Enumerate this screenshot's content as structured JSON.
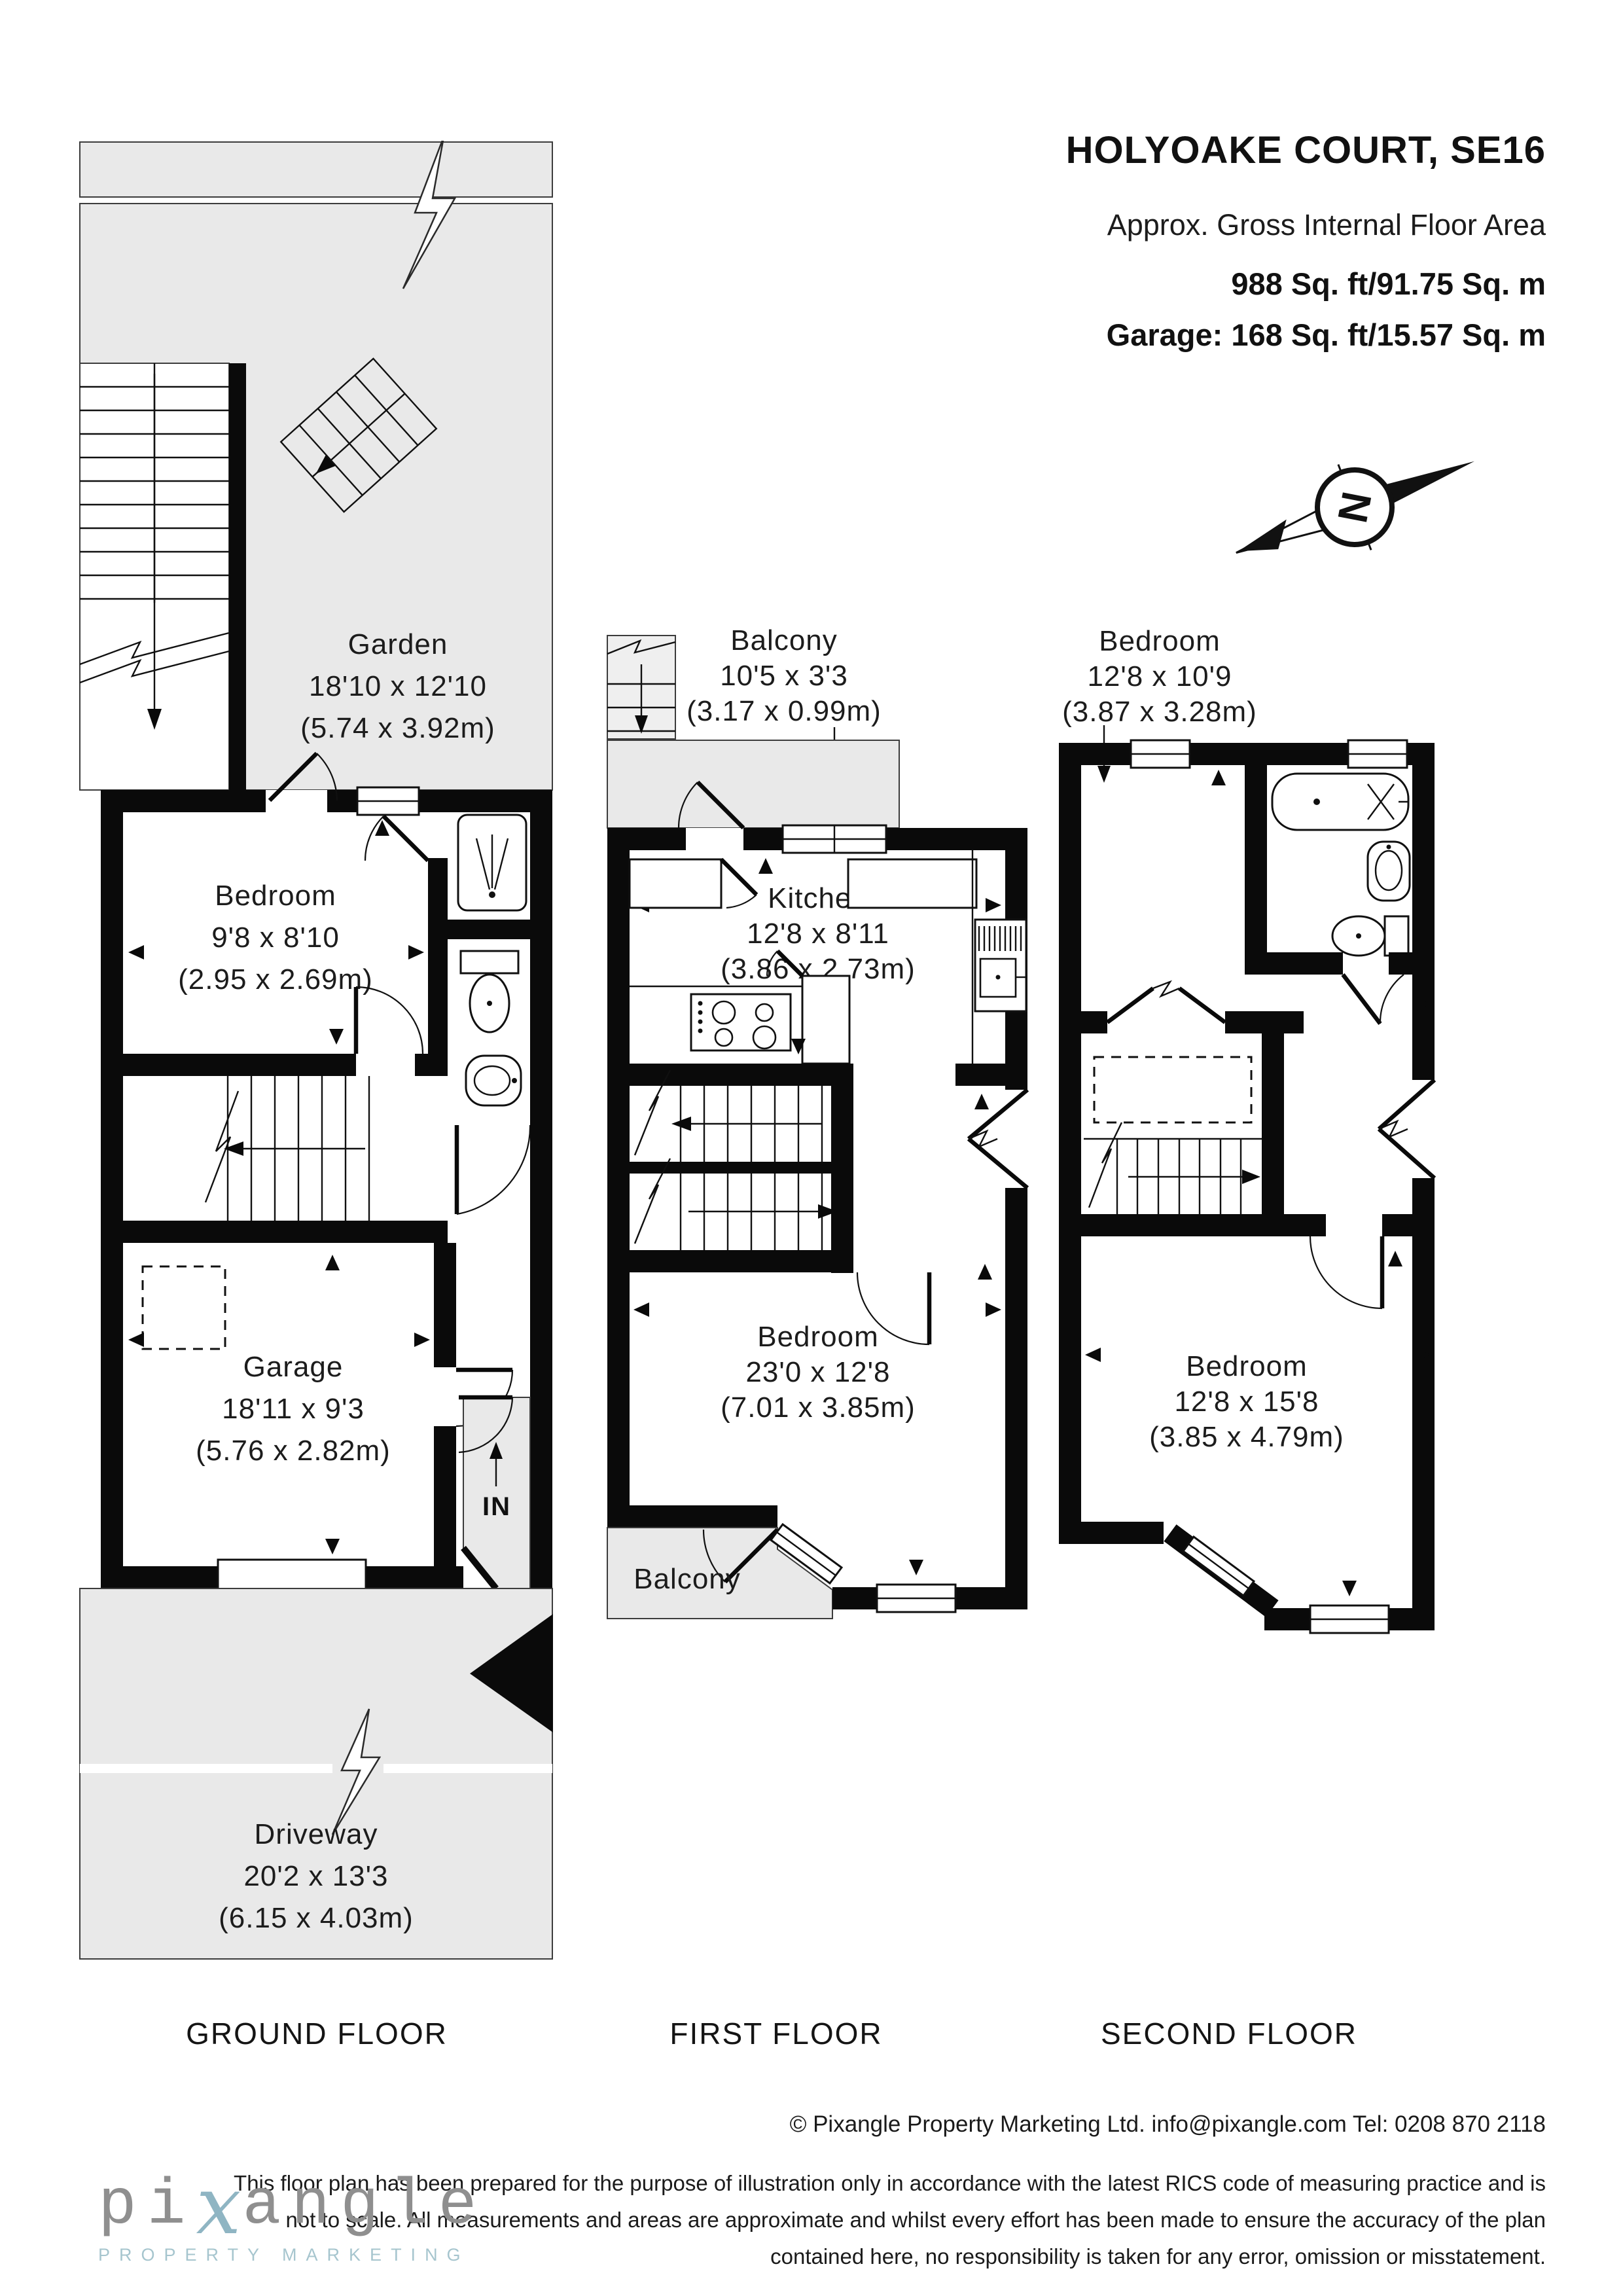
{
  "header": {
    "title": "HOLYOAKE COURT, SE16",
    "subtitle": "Approx. Gross Internal Floor Area",
    "area_total": "988 Sq. ft/91.75 Sq. m",
    "area_garage": "Garage: 168 Sq. ft/15.57 Sq. m"
  },
  "compass": {
    "north_label": "N"
  },
  "floors": {
    "ground": {
      "label": "GROUND FLOOR",
      "entrance_label": "IN",
      "rooms": {
        "garden": {
          "name": "Garden",
          "imperial": "18'10 x 12'10",
          "metric": "(5.74 x 3.92m)"
        },
        "bedroom": {
          "name": "Bedroom",
          "imperial": "9'8 x 8'10",
          "metric": "(2.95 x 2.69m)"
        },
        "garage": {
          "name": "Garage",
          "imperial": "18'11 x 9'3",
          "metric": "(5.76 x 2.82m)"
        },
        "driveway": {
          "name": "Driveway",
          "imperial": "20'2 x 13'3",
          "metric": "(6.15 x 4.03m)"
        }
      }
    },
    "first": {
      "label": "FIRST FLOOR",
      "rooms": {
        "balcony_top": {
          "name": "Balcony",
          "imperial": "10'5 x 3'3",
          "metric": "(3.17 x 0.99m)"
        },
        "kitchen": {
          "name": "Kitchen",
          "imperial": "12'8 x 8'11",
          "metric": "(3.86 x 2.73m)"
        },
        "bedroom": {
          "name": "Bedroom",
          "imperial": "23'0 x 12'8",
          "metric": "(7.01 x 3.85m)"
        },
        "balcony_bottom": {
          "name": "Balcony"
        }
      }
    },
    "second": {
      "label": "SECOND FLOOR",
      "rooms": {
        "bedroom_top": {
          "name": "Bedroom",
          "imperial": "12'8 x 10'9",
          "metric": "(3.87 x 3.28m)"
        },
        "bedroom_bottom": {
          "name": "Bedroom",
          "imperial": "12'8 x 15'8",
          "metric": "(3.85 x 4.79m)"
        }
      }
    }
  },
  "footer": {
    "copyright": "© Pixangle Property Marketing Ltd. info@pixangle.com Tel: 0208 870 2118",
    "disclaimer_line1": "This floor plan has been prepared for the purpose of illustration only in accordance with the latest RICS code of measuring practice and is",
    "disclaimer_line2": "not to scale. All measurements and areas are approximate and whilst every effort has been made to ensure the accuracy of the plan",
    "disclaimer_line3": "contained here, no responsibility is taken for any error, omission or misstatement."
  },
  "logo": {
    "part1": "pi",
    "x": "x",
    "part2": "angle",
    "tagline": "PROPERTY MARKETING"
  },
  "colors": {
    "outdoor_fill": "#e9e9e9",
    "wall": "#0a0a0a",
    "logo_gray": "#8f8f8f",
    "logo_blue": "#8fb5c3",
    "tagline_blue": "#a6c5ce"
  }
}
